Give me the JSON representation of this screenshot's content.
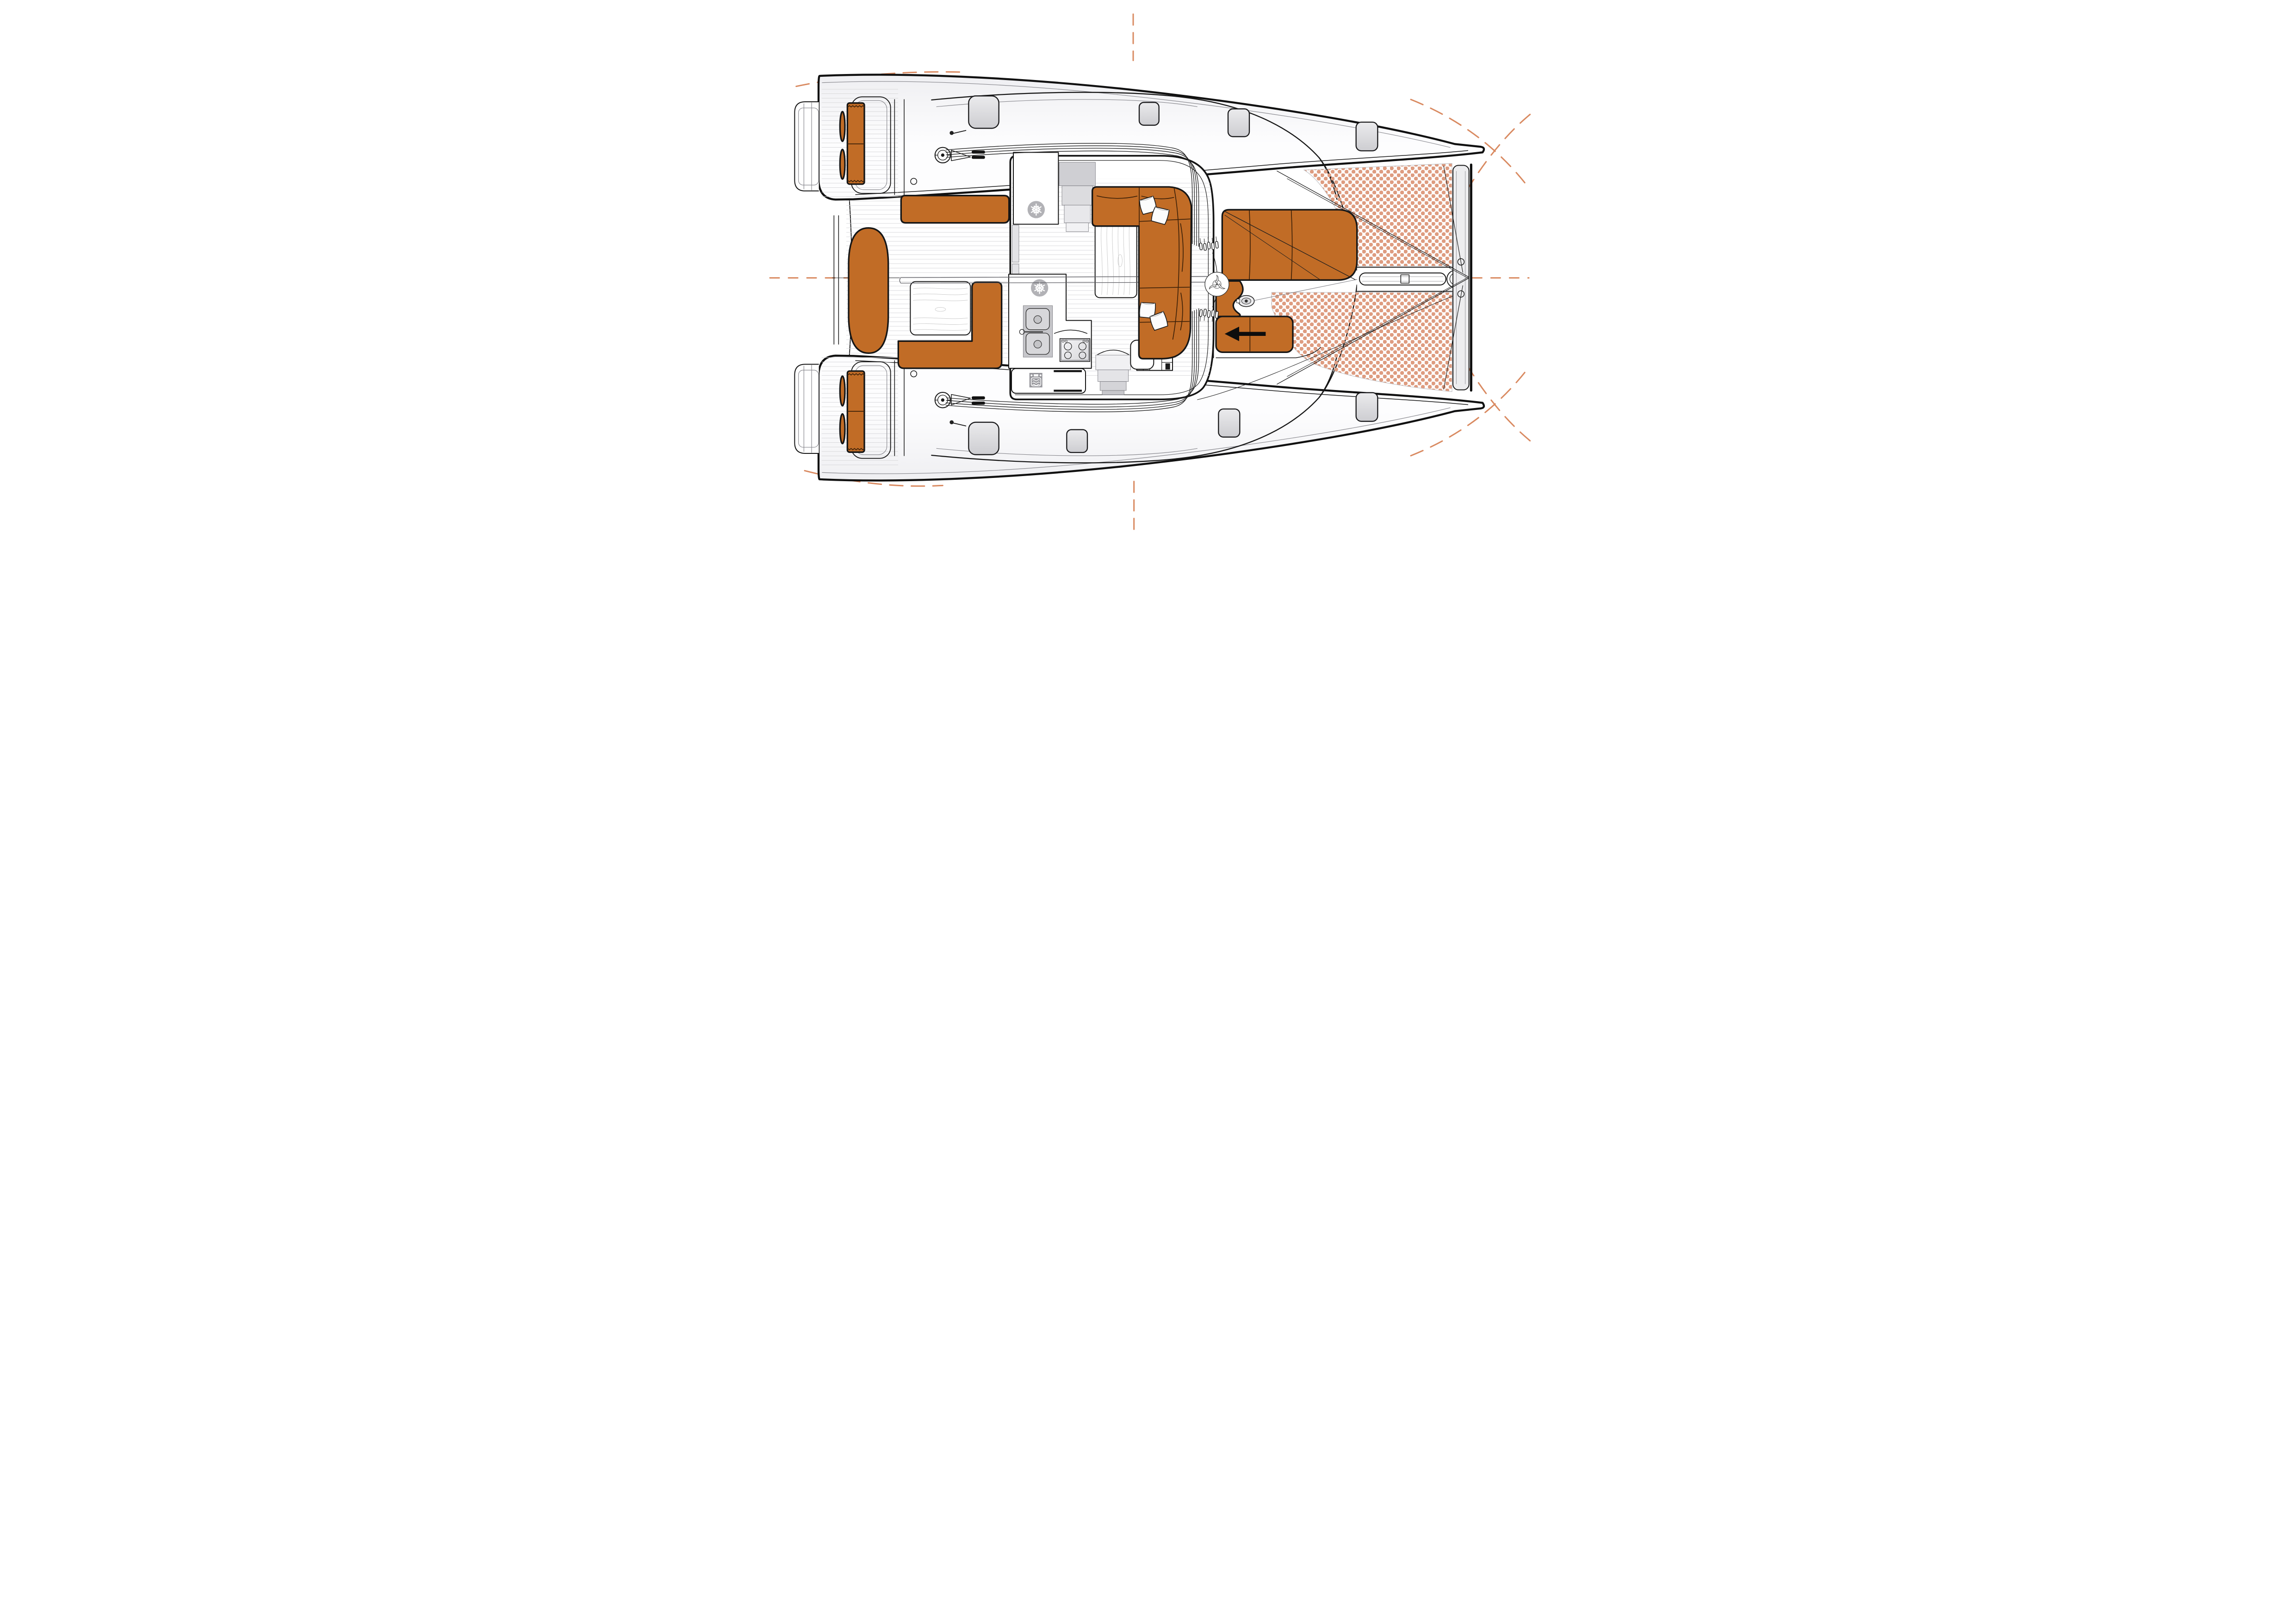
{
  "meta": {
    "domain": "Diagram",
    "visible_text": []
  },
  "theme": {
    "ink": "#161616",
    "upholstery": "#c16c26",
    "upholstery_seam": "#3c2008",
    "tramp_dot": "#de9c80",
    "mark": "#d98a61",
    "deck_plank": "#d3d3d6",
    "panel_gray": "#c6c6ca",
    "hatch_hi": "#ebebed",
    "hatch_lo": "#cdcdd1",
    "wood": "#c7c7c7"
  },
  "diagram": {
    "type": "floorplan",
    "title": "Catamaran deck and saloon layout, plan view, bow to the right",
    "orientation": {
      "bow": "right",
      "stern": "left",
      "port_hull": "top",
      "starboard_hull": "bottom"
    },
    "areas": {
      "hull_port": {
        "label": "Port hull deck"
      },
      "hull_starboard": {
        "label": "Starboard hull deck"
      },
      "transom_port": {
        "label": "Port transom swim steps"
      },
      "transom_starboard": {
        "label": "Starboard transom swim steps"
      },
      "aft_platform": {
        "label": "Aft central platform"
      },
      "aft_cockpit": {
        "label": "Aft cockpit"
      },
      "helm_port": {
        "label": "Port helm station with cushioned seat"
      },
      "helm_starboard": {
        "label": "Starboard helm station with cushioned seat"
      },
      "cockpit_lounge": {
        "label": "Cockpit lounge pad"
      },
      "cockpit_bench_aft": {
        "label": "Cockpit bench along saloon bulkhead"
      },
      "cockpit_bench_l": {
        "label": "L-shaped cockpit bench"
      },
      "cockpit_table": {
        "label": "Cockpit teak table"
      },
      "saloon": {
        "label": "Saloon"
      },
      "galley": {
        "label": "Galley"
      },
      "refrigerator_fwd": {
        "label": "Refrigerator (forward)"
      },
      "refrigerator_aft": {
        "label": "Refrigerator (aft)"
      },
      "sink": {
        "label": "Twin galley sink"
      },
      "stove": {
        "label": "Four-burner stove"
      },
      "oven": {
        "label": "Oven drawer"
      },
      "companionway_port": {
        "label": "Companionway steps to port hull"
      },
      "companionway_starboard": {
        "label": "Companionway steps to starboard hull"
      },
      "saloon_sofa": {
        "label": "L-shaped saloon sofa"
      },
      "saloon_table": {
        "label": "Saloon table"
      },
      "locker": {
        "label": "Aft storage locker"
      },
      "nav_seat": {
        "label": "Seat / step module"
      },
      "sliding_door": {
        "label": "Sliding door panels"
      },
      "mast": {
        "label": "Mast base with rope clutches"
      },
      "winch_port": {
        "label": "Port coachroof winch with cleat"
      },
      "winch_starboard": {
        "label": "Starboard coachroof winch with cleat"
      },
      "boom": {
        "label": "Boom over cockpit centreline"
      },
      "sunpad": {
        "label": "Coachroof sunpad, three sections"
      },
      "forward_cockpit_bench": {
        "label": "Forward cockpit bench with direction arrow"
      },
      "windlass": {
        "label": "Anchor windlass"
      },
      "trampoline_port": {
        "label": "Port trampoline net"
      },
      "trampoline_starboard": {
        "label": "Starboard trampoline net"
      },
      "crossbeam": {
        "label": "Forward crossbeam"
      },
      "bowsprit": {
        "label": "Bowsprit longeron with furler"
      },
      "hatches": {
        "label": "Deck hatches"
      },
      "rigging": {
        "label": "Running rigging led aft to winches"
      },
      "registration_marks": {
        "label": "Orange dashed registration marks"
      }
    },
    "fixtures": {
      "deck_hatches": 8,
      "scatter_pillows": 4,
      "stove_burners": 4,
      "sink_basins": 2,
      "refrigerators": 2,
      "helm_stations": 2,
      "trampolines": 2,
      "winches": 2,
      "companionways": 2,
      "sunpad_sections": 3,
      "forward_bench_arrow_direction": "left"
    }
  }
}
